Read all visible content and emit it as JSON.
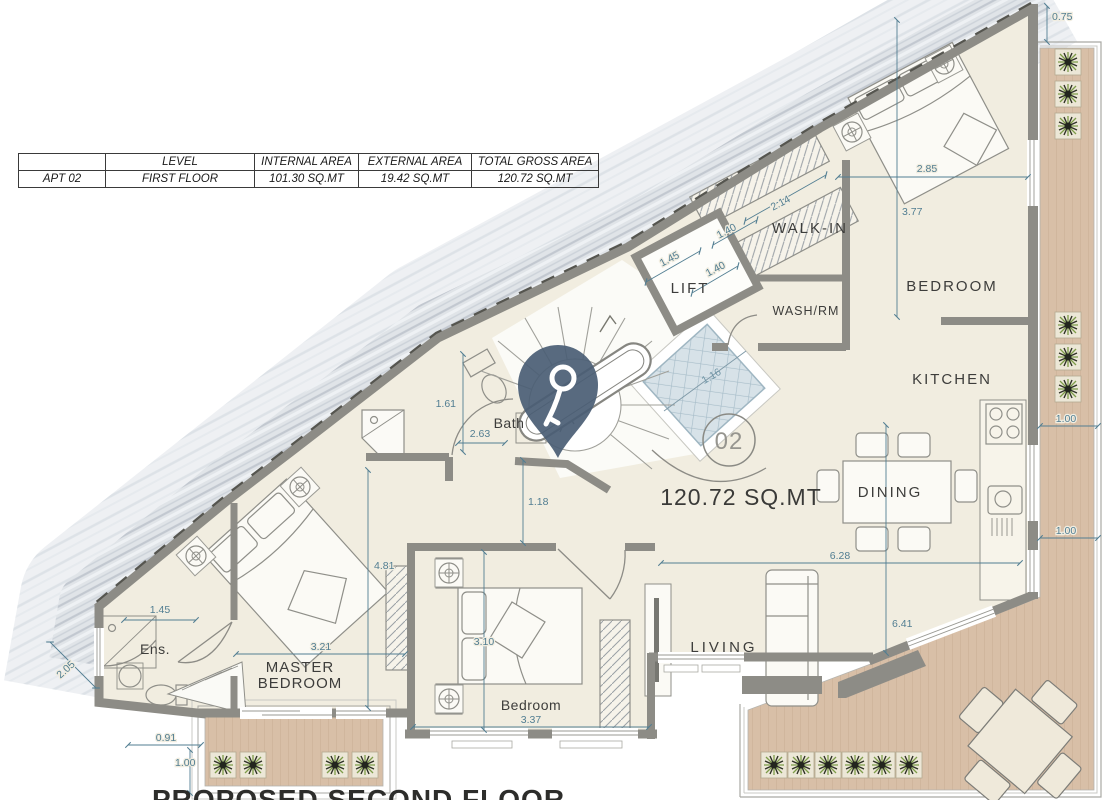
{
  "title_block": {
    "proposed_title": "PROPOSED SECOND FLOOR"
  },
  "area_table": {
    "headers": [
      "",
      "LEVEL",
      "INTERNAL AREA",
      "EXTERNAL AREA",
      "TOTAL GROSS AREA"
    ],
    "row": [
      "APT 02",
      "FIRST FLOOR",
      "101.30 SQ.MT",
      "19.42 SQ.MT",
      "120.72 SQ.MT"
    ]
  },
  "rooms": {
    "walk_in": "WALK-IN",
    "bedroom_top": "BEDROOM",
    "lift": "LIFT",
    "wash_rm": "WASH/RM",
    "kitchen": "KITCHEN",
    "dining": "DINING",
    "bath": "Bath",
    "ensuite": "Ens.",
    "master_line1": "MASTER",
    "master_line2": "BEDROOM",
    "bedroom_bottom": "Bedroom",
    "living": "LIVING"
  },
  "annotations": {
    "apartment_number": "02",
    "total_area_label": "120.72 SQ.MT"
  },
  "dimensions": {
    "top_right_gap": "0.75",
    "bedroom_top_width": "2.85",
    "bedroom_top_height": "3.77",
    "walk_in_length": "2.14",
    "walk_in_width": "1.40",
    "lift_width": "1.45",
    "lift_depth": "1.40",
    "skylight_width": "1.16",
    "bath_width": "1.61",
    "bath_length": "2.63",
    "hall_width": "1.18",
    "master_height": "4.81",
    "master_width": "3.21",
    "ensuite_width": "1.45",
    "ensuite_depth": "2.05",
    "balcony_offset": "0.91",
    "balcony_depth_left": "1.00",
    "bedroom_bottom_width": "3.10",
    "bedroom_bottom_length": "3.37",
    "living_width": "6.28",
    "living_height": "6.41",
    "terrace_depth_top": "1.00",
    "terrace_depth_bottom": "1.00"
  },
  "icons": {
    "marker": "key-location-pin"
  },
  "colors": {
    "floor": "#f1ede0",
    "wall": "#8e8d88",
    "deck": "#d8bfa7",
    "dimension": "#527e92",
    "marker": "#4a5d74",
    "skylight": "#d7e2e8"
  }
}
